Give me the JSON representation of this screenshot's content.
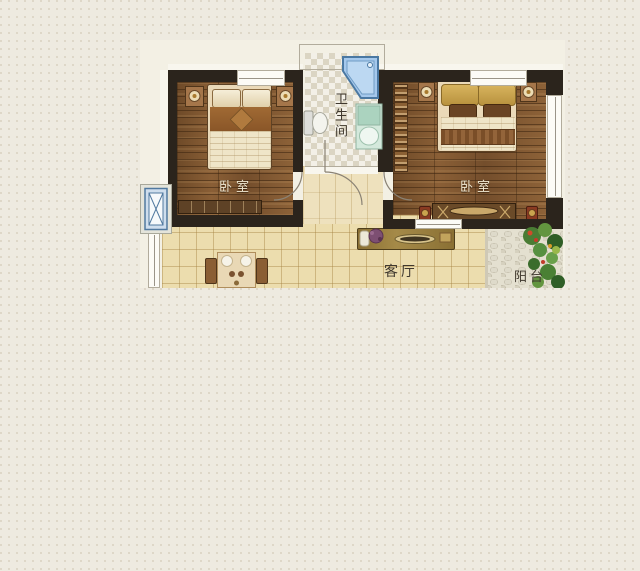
{
  "plan": {
    "labels": {
      "bedroom_left": "卧室",
      "bedroom_right": "卧室",
      "bathroom": "卫生间",
      "living_room": "客厅",
      "balcony": "阳台"
    },
    "palette": {
      "page_bg": "#eeeae0",
      "wall": "#2b241c",
      "wood_floor": "#7d5631",
      "living_tile": "#ecddae",
      "bath_checker": "#dbd5c3",
      "bathtub_blue": "#a5c8ec",
      "vanity_green": "#abd3bf",
      "balcony_stone": "#e4e0d0",
      "plant_green": "#4a7c34",
      "bed_gold": "#c9a44e",
      "shaft_blue": "#cfdeed",
      "label_light": "#f0e8d2",
      "label_dark": "#3f382e"
    }
  }
}
